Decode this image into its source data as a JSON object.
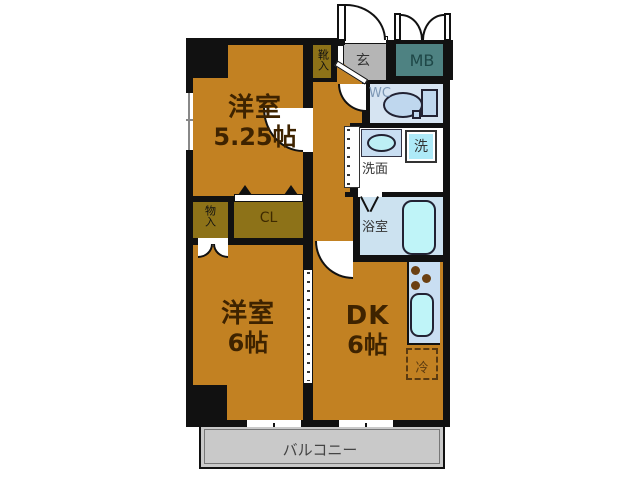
{
  "floorplan": {
    "rooms": {
      "western_room_1": {
        "label": "洋室",
        "size": "5.25帖"
      },
      "western_room_2": {
        "label": "洋室",
        "size": "6帖"
      },
      "dining_kitchen": {
        "label": "DK",
        "size": "6帖"
      },
      "balcony": {
        "label": "バルコニー"
      },
      "entrance": {
        "label": "玄"
      },
      "meter_box": {
        "label": "MB"
      },
      "toilet": {
        "label": "WC"
      },
      "washroom": {
        "label": "洗面"
      },
      "washing_machine": {
        "label": "洗"
      },
      "bathroom": {
        "label": "浴室"
      },
      "refrigerator": {
        "label": "冷"
      },
      "shoe_storage": {
        "label": "靴入"
      },
      "storage": {
        "label": "物入"
      },
      "closet": {
        "label": "CL"
      }
    },
    "colors": {
      "wall": "#111111",
      "room_floor": "#C28122",
      "closet_floor": "#8D7218",
      "entrance_floor": "#B5B5B5",
      "meter_box": "#4E8282",
      "wet_room_floor": "#D6E4F2",
      "bathroom_floor": "#CCE2F0",
      "kitchen_counter": "#C9DEF2",
      "fixture_fill": "#BFF4F8",
      "toilet_fill": "#BFD7EE",
      "washer_fill": "#AEEAF8",
      "balcony_floor": "#C9C9C9",
      "label_text": "#3E2300"
    }
  }
}
